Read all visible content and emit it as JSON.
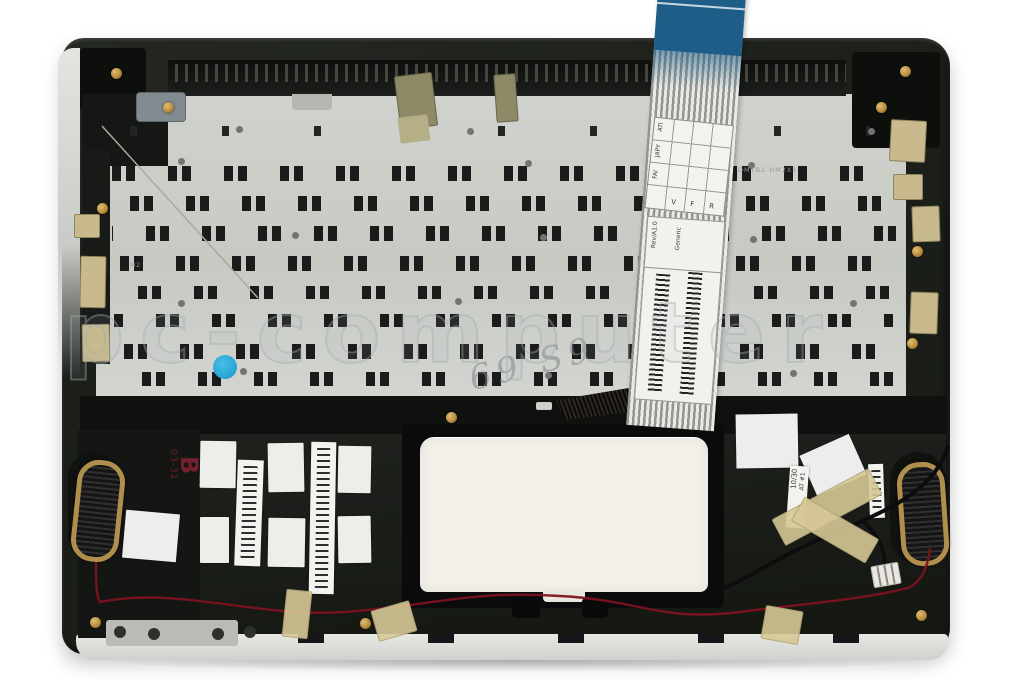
{
  "meta": {
    "description": "Product photo of a laptop palmrest top case assembly, underside view, with keyboard backplate, keyboard ribbon cable, speakers, touchpad and service stickers"
  },
  "watermark": {
    "text": "pc-computer"
  },
  "cable": {
    "grid_label": {
      "col_texts": [
        "ATI",
        "JAPY",
        "FAI"
      ],
      "row_texts": [
        "V",
        "F",
        "R"
      ]
    },
    "barcode_label": {
      "rev": "Rev/A1.0",
      "name": "Generic"
    }
  },
  "stamps": {
    "red_main": "B",
    "red_sub": "03-31",
    "date_label": "10/30",
    "station_label": "AT #1"
  },
  "etched": {
    "plate_code": "DMTB2 HM2X1",
    "plate_mark": "M2"
  },
  "handwriting": {
    "text": "69 S9"
  },
  "colors": {
    "ribbon_blue": "#1e5d87",
    "speaker_gold": "#b08e4c",
    "sticker_blue": "#2aa8d8",
    "wire_red": "#7c1220",
    "tape_beige": "#d6c896",
    "stamp_red": "#7e2030",
    "chassis_dark": "#1c1f1a",
    "plate_silver": "#c9cbc5",
    "touchpad_white": "#f2f0e9"
  }
}
